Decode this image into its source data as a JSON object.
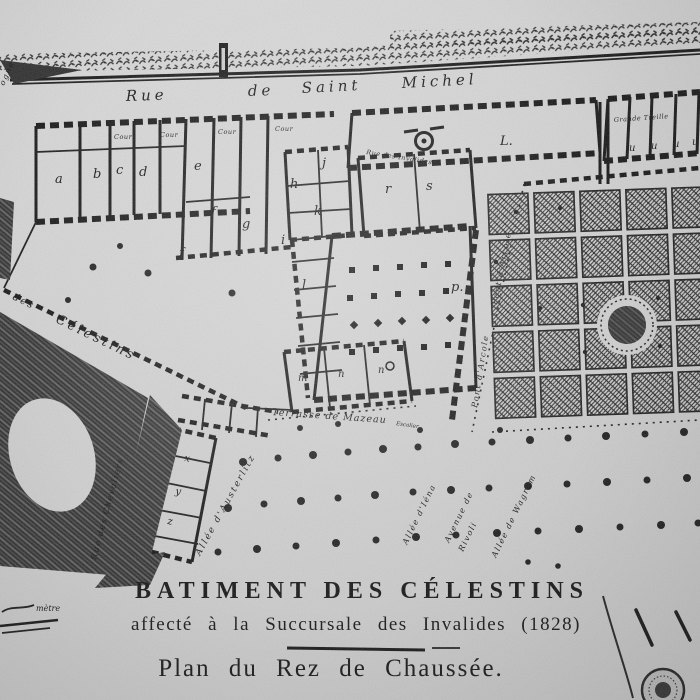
{
  "map": {
    "streets": {
      "rsm": [
        "Rue",
        "de",
        "Saint",
        "Michel"
      ],
      "des": "des",
      "celestins": "Célestins",
      "chevaliers": "Rue des Chevaliers",
      "pont_arcole": "Pont d'Arcole",
      "invalides_lane": "Rue des Invalides",
      "corner_partial": "ogne"
    },
    "garden_alleys": {
      "austerlitz": "Allée d'Austerlitz",
      "iena": "Allée d'Iéna",
      "rivoli_1": "Avenue de",
      "rivoli_2": "Rivoli",
      "wagram": "Allée de Wagram"
    },
    "labels": {
      "terrasse": "Terrasse de Mazeau",
      "escalier": "Escalier",
      "cour": "Cour",
      "treille": "Grande Treille",
      "hall": "L.",
      "scale_note": "mètre"
    },
    "rooms": [
      "a",
      "b",
      "c",
      "d",
      "e",
      "f",
      "g",
      "f",
      "h",
      "j",
      "k",
      "i",
      "l",
      "r",
      "s",
      "p.",
      "m",
      "n",
      "n",
      "u",
      "u",
      "u",
      "u",
      "x",
      "y",
      "z"
    ],
    "title": {
      "line1": "BATIMENT DES CÉLESTINS",
      "line2": "affecté à la Succursale des Invalides (1828)",
      "line3": "Plan du Rez de Chaussée."
    }
  }
}
